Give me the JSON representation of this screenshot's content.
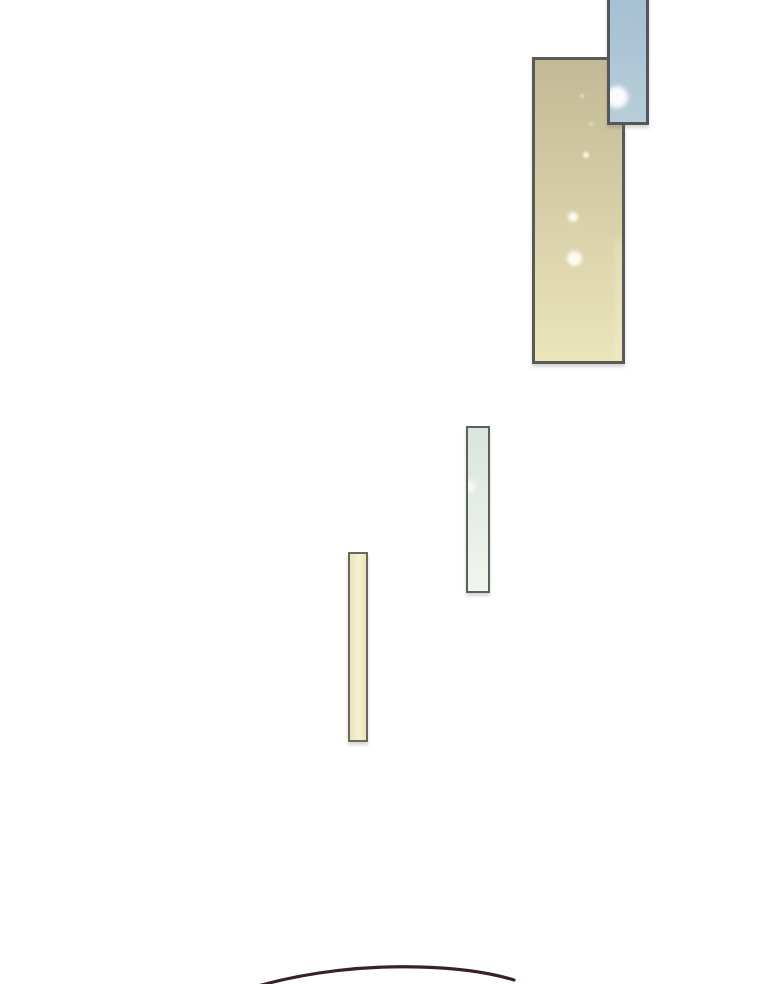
{
  "scene": {
    "description": "webtoon vertical-scroll transition area: mostly white gutter with window panes catching light and the top of a dark-haired head entering from the bottom",
    "background": "#ffffff"
  },
  "panels": {
    "tan_panel": {
      "name": "large tan window panel",
      "border": "#5b5a55",
      "fill_top": "#c2b996",
      "fill_bottom": "#ebe5ba",
      "sparkle": "#fffdf0"
    },
    "blue_pane": {
      "name": "blue sky window pane (cut off by top edge)",
      "border": "#53565a",
      "fill_top": "#a4bfd3",
      "fill_bottom": "#b7cdd9",
      "sparkle": "#ffffff"
    },
    "glass_pane": {
      "name": "narrow pale glass pane",
      "border": "#5c605e",
      "fill_top": "#d8e5dd",
      "fill_bottom": "#f2f5ef",
      "sparkle": "#ffffff"
    },
    "cream_pane": {
      "name": "narrow cream pane",
      "border": "#6a675f",
      "fill_top": "#eae3b8",
      "fill_bottom": "#f7f2d0"
    }
  },
  "hair_arc": {
    "name": "dark hair silhouette arc at bottom edge",
    "stroke": "#3a2129",
    "path": "M 251 988 C 308 971 368 965.5 420 967 C 456 968 488 972 514 980"
  }
}
